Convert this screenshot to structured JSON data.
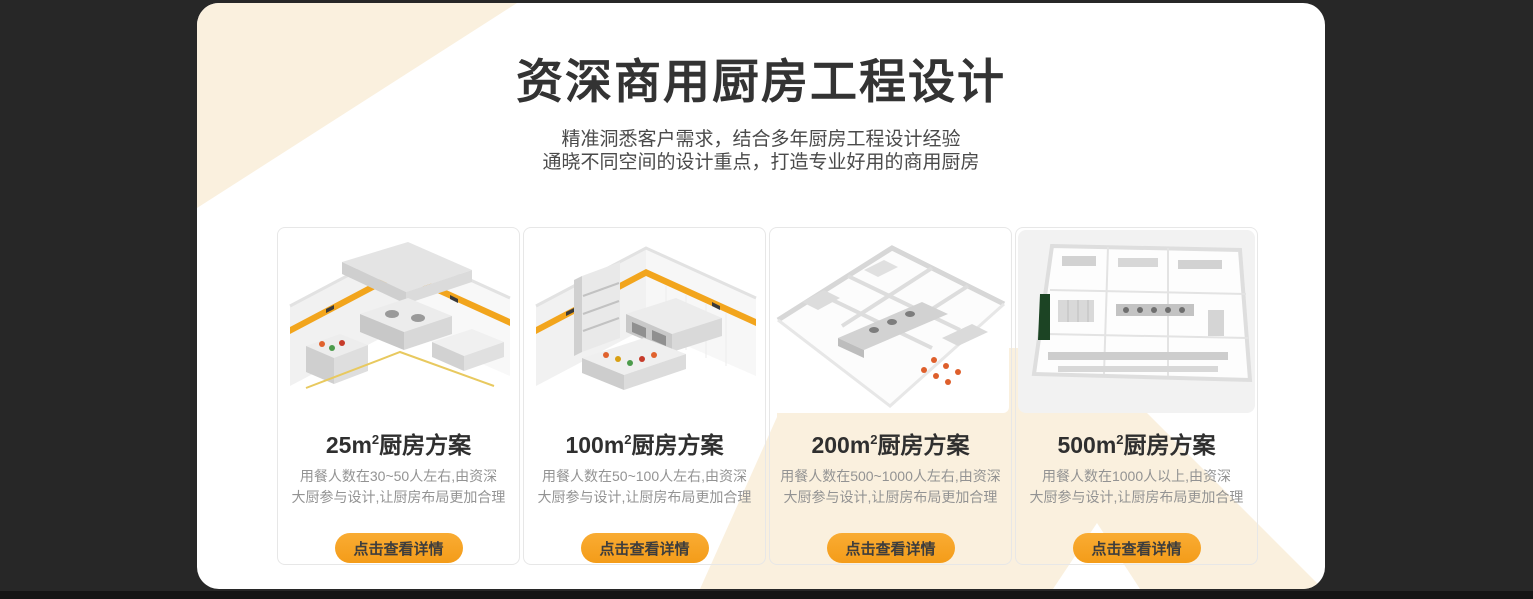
{
  "theme": {
    "page_background": "#272727",
    "panel_background": "#ffffff",
    "decor_cream": "#faf0de",
    "accent_orange": "#f5a01e",
    "stripe_yellow": "#f2a51d",
    "title_color": "#333333",
    "description_color": "#939393",
    "footer_strip_color": "#151515"
  },
  "header": {
    "title": "资深商用厨房工程设计",
    "subtitle_line1": "精准洞悉客户需求，结合多年厨房工程设计经验",
    "subtitle_line2": "通晓不同空间的设计重点，打造专业好用的商用厨房"
  },
  "cards": [
    {
      "title_area": "25m",
      "title_sup": "2",
      "title_suffix": "厨房方案",
      "desc_line1": "用餐人数在30~50人左右,由资深",
      "desc_line2": "大厨参与设计,让厨房布局更加合理",
      "button_label": "点击查看详情"
    },
    {
      "title_area": "100m",
      "title_sup": "2",
      "title_suffix": "厨房方案",
      "desc_line1": "用餐人数在50~100人左右,由资深",
      "desc_line2": "大厨参与设计,让厨房布局更加合理",
      "button_label": "点击查看详情"
    },
    {
      "title_area": "200m",
      "title_sup": "2",
      "title_suffix": "厨房方案",
      "desc_line1": "用餐人数在500~1000人左右,由资深",
      "desc_line2": "大厨参与设计,让厨房布局更加合理",
      "button_label": "点击查看详情"
    },
    {
      "title_area": "500m",
      "title_sup": "2",
      "title_suffix": "厨房方案",
      "desc_line1": "用餐人数在1000人以上,由资深",
      "desc_line2": "大厨参与设计,让厨房布局更加合理",
      "button_label": "点击查看详情"
    }
  ]
}
